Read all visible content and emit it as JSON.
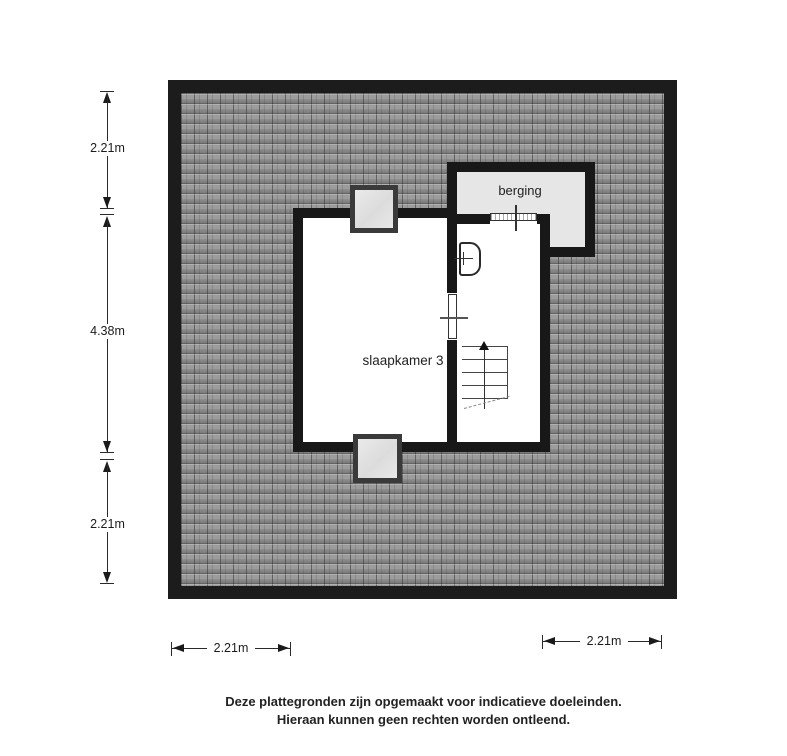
{
  "plan": {
    "rooms": {
      "slaapkamer": {
        "label": "slaapkamer 3"
      },
      "berging": {
        "label": "berging"
      }
    },
    "features": {
      "stairs": "stairs-up",
      "sink": "wash-basin",
      "door": "hinged-door",
      "sliding_door": "berging-entry-door",
      "dormers": [
        "dormer-top",
        "dormer-bottom"
      ]
    }
  },
  "dimensions": {
    "left": [
      {
        "id": "top",
        "label": "2.21m"
      },
      {
        "id": "middle",
        "label": "4.38m"
      },
      {
        "id": "bottom",
        "label": "2.21m"
      }
    ],
    "bottom": [
      {
        "id": "left",
        "label": "2.21m"
      },
      {
        "id": "right",
        "label": "2.21m"
      }
    ]
  },
  "footer": {
    "line1": "Deze plattegronden zijn opgemaakt voor indicatieve doeleinden.",
    "line2": "Hieraan kunnen geen rechten worden ontleend."
  },
  "colors": {
    "wall": "#1c1c1c",
    "roof_base": "#9c9c9c",
    "roof_line": "#5f5f5f",
    "room_fill": "#ffffff",
    "berging_fill": "#e6e6e6",
    "dormer_fill": "#e3e3e3",
    "text": "#1f1f1f"
  }
}
